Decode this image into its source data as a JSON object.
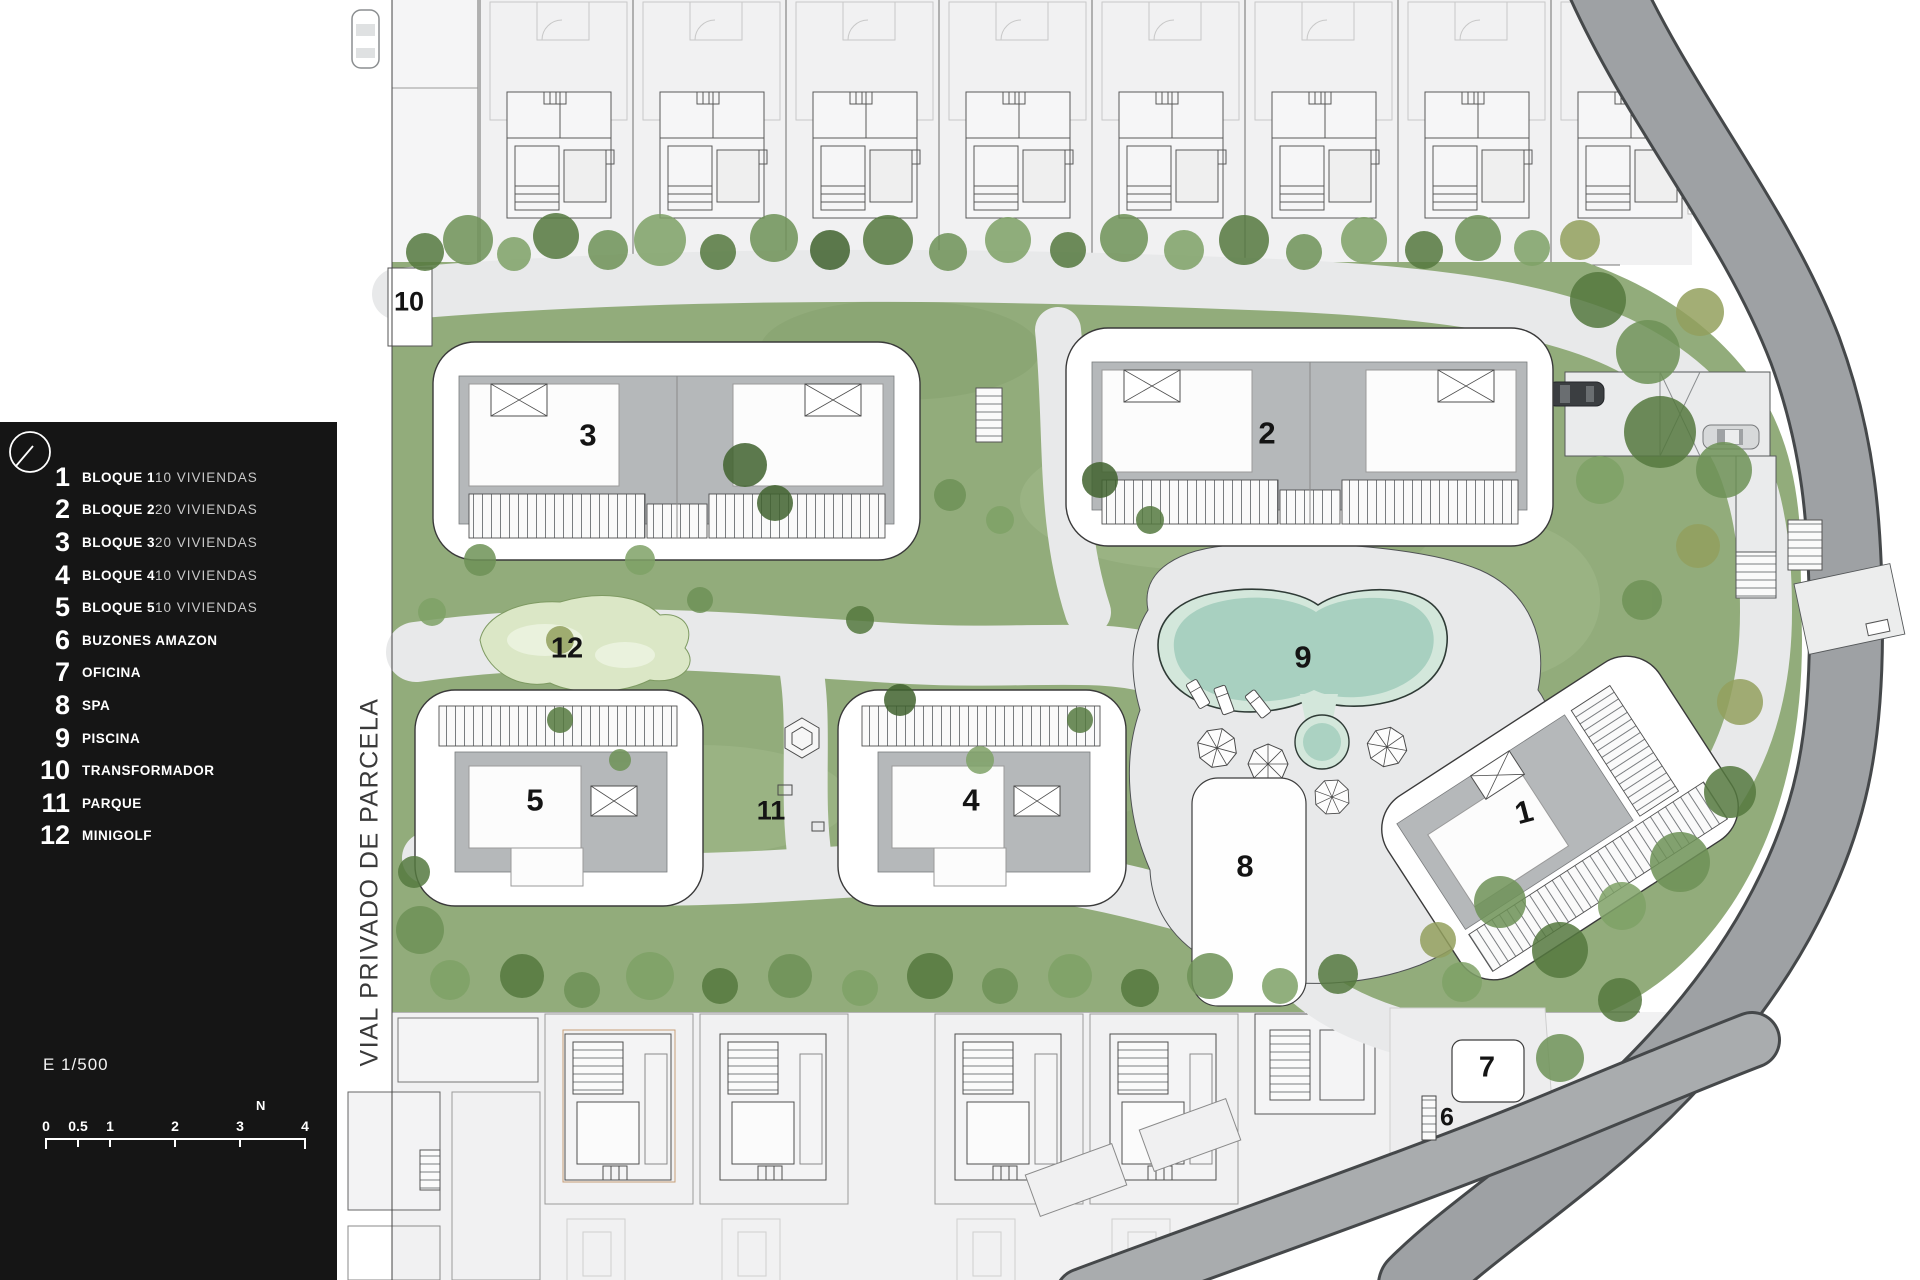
{
  "legend": {
    "items": [
      {
        "num": "1",
        "label": "BLOQUE 1",
        "sub": "10 VIVIENDAS"
      },
      {
        "num": "2",
        "label": "BLOQUE 2",
        "sub": "20 VIVIENDAS"
      },
      {
        "num": "3",
        "label": "BLOQUE 3",
        "sub": "20 VIVIENDAS"
      },
      {
        "num": "4",
        "label": "BLOQUE 4",
        "sub": "10 VIVIENDAS"
      },
      {
        "num": "5",
        "label": "BLOQUE 5",
        "sub": "10 VIVIENDAS"
      },
      {
        "num": "6",
        "label": "BUZONES AMAZON"
      },
      {
        "num": "7",
        "label": "OFICINA"
      },
      {
        "num": "8",
        "label": "SPA"
      },
      {
        "num": "9",
        "label": "PISCINA"
      },
      {
        "num": "10",
        "label": "TRANSFORMADOR"
      },
      {
        "num": "11",
        "label": "PARQUE"
      },
      {
        "num": "12",
        "label": "MINIGOLF"
      }
    ],
    "scale_text": "E 1/500",
    "north_label": "N",
    "scale_bar_ticks": [
      "0",
      "0.5",
      "1",
      "2",
      "3",
      "4"
    ]
  },
  "plan": {
    "street_label": "VIAL PRIVADO DE PARCELA",
    "markers": [
      {
        "id": "block-1",
        "text": "1"
      },
      {
        "id": "block-2",
        "text": "2"
      },
      {
        "id": "block-3",
        "text": "3"
      },
      {
        "id": "block-4",
        "text": "4"
      },
      {
        "id": "block-5",
        "text": "5"
      },
      {
        "id": "buzones-6",
        "text": "6"
      },
      {
        "id": "oficina-7",
        "text": "7"
      },
      {
        "id": "spa-8",
        "text": "8"
      },
      {
        "id": "pool-9",
        "text": "9"
      },
      {
        "id": "transformador-10",
        "text": "10"
      },
      {
        "id": "parque-11",
        "text": "11"
      },
      {
        "id": "minigolf-12",
        "text": "12"
      }
    ]
  },
  "colors": {
    "legend_bg": "#151515",
    "lawn": "#92ac7b",
    "path": "#e8e9ea",
    "road": "#9ea1a4",
    "roof": "#b5b8ba",
    "pool_water": "#a8d0c0",
    "pool_rim": "#d3e7db",
    "minigolf": "#dbe7c6"
  }
}
